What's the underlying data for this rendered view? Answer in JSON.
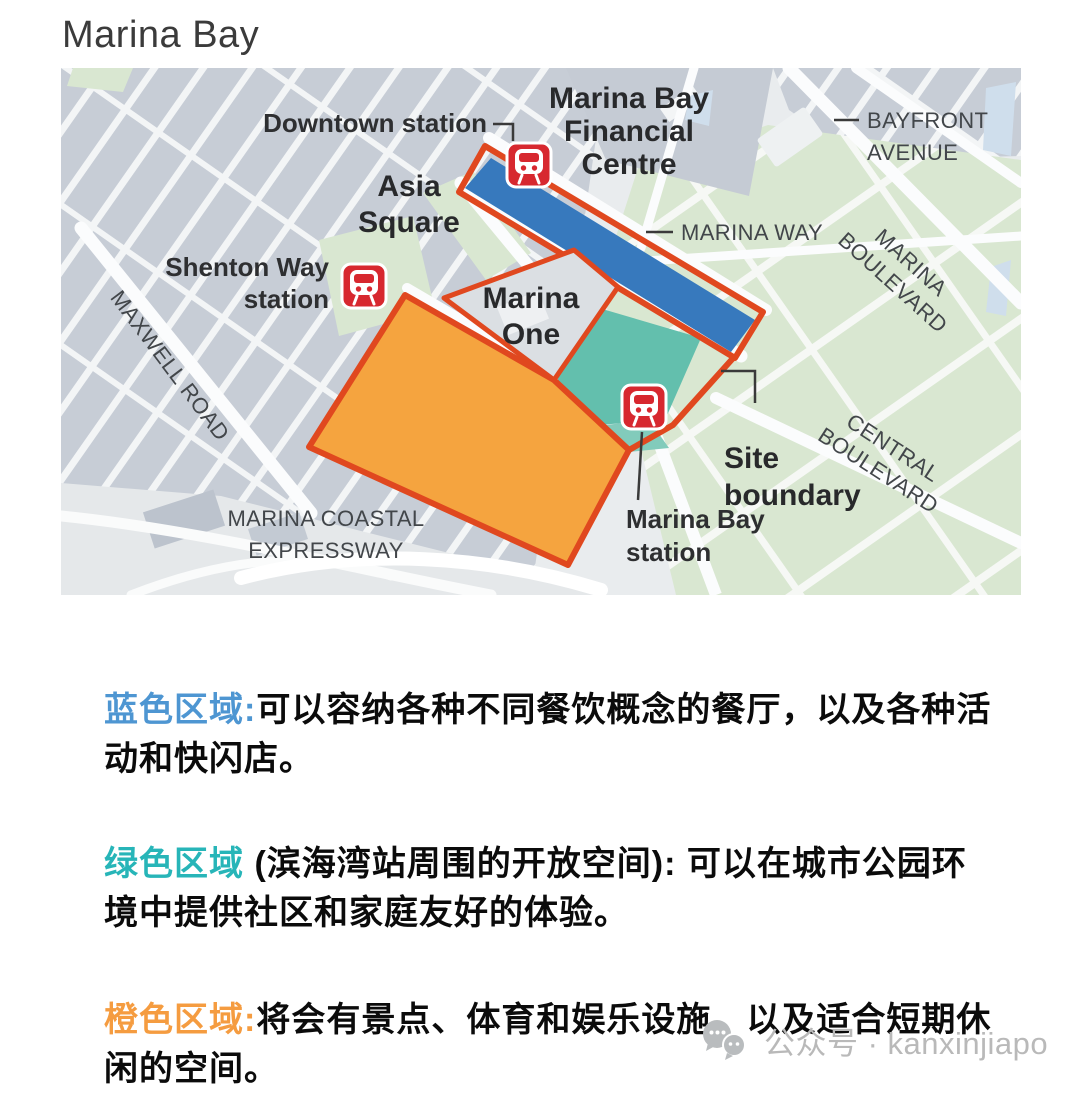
{
  "page": {
    "title": "Marina Bay"
  },
  "map": {
    "colors": {
      "blue_zone": "#3779BD",
      "green_zone": "#63BFAD",
      "orange_zone": "#F5A43F",
      "site_boundary_line": "#E0481F",
      "station_icon_red": "#D7282F",
      "city_block_gray": "#C7CDD6",
      "park_green": "#D9E7D1",
      "water_blue": "#CFDEEC"
    },
    "labels": {
      "downtown_station": "Downtown station",
      "mbfc1": "Marina Bay",
      "mbfc2": "Financial",
      "mbfc3": "Centre",
      "bayfront1": "BAYFRONT",
      "bayfront2": "AVENUE",
      "asia1": "Asia",
      "asia2": "Square",
      "marina_way": "MARINA WAY",
      "marina_blvd1": "MARINA",
      "marina_blvd2": "BOULEVARD",
      "shenton1": "Shenton Way",
      "shenton2": "station",
      "marina_one1": "Marina",
      "marina_one2": "One",
      "maxwell_road": "MAXWELL ROAD",
      "central1": "CENTRAL",
      "central2": "BOULEVARD",
      "site1": "Site",
      "site2": "boundary",
      "mb_station1": "Marina Bay",
      "mb_station2": "station",
      "mce1": "MARINA COASTAL",
      "mce2": "EXPRESSWAY"
    }
  },
  "legend": {
    "items": [
      {
        "heading": "蓝色区域:",
        "heading_color": "#4E96D2",
        "body": "可以容纳各种不同餐饮概念的餐厅，以及各种活动和快闪店。"
      },
      {
        "heading": "绿色区域",
        "heading_color": "#27B5B8",
        "body": " (滨海湾站周围的开放空间): 可以在城市公园环境中提供社区和家庭友好的体验。"
      },
      {
        "heading": "橙色区域:",
        "heading_color": "#F59C40",
        "body": "将会有景点、体育和娱乐设施，以及适合短期休闲的空间。"
      }
    ]
  },
  "watermark": {
    "text": "公众号 · kanxinjiapo"
  }
}
